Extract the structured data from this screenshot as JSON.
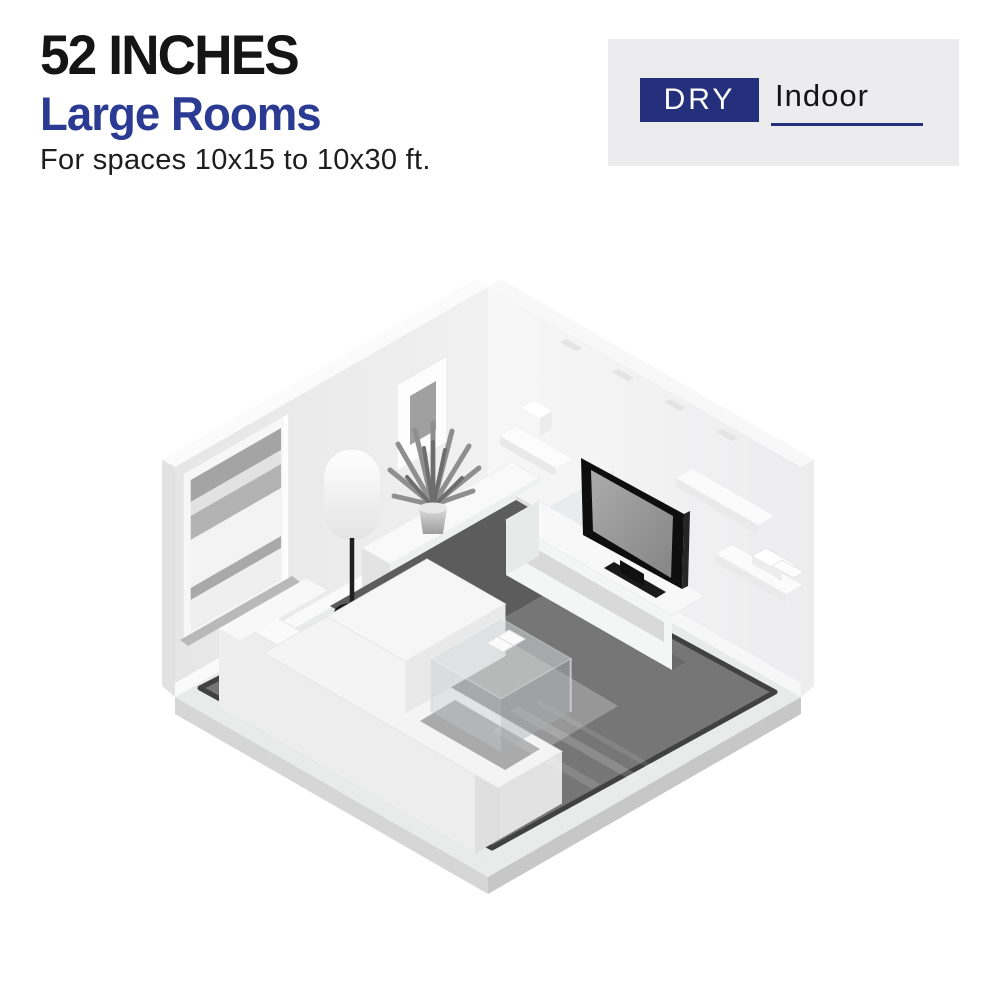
{
  "header": {
    "size_label": "52 INCHES",
    "room_label": "Large Rooms",
    "subtitle": "For spaces 10x15 to 10x30 ft."
  },
  "rating_badge": {
    "dry_label": "DRY",
    "location_label": "Indoor"
  },
  "colors": {
    "accent_blue": "#2b3a92",
    "badge_navy": "#24307c",
    "panel_gray": "#ececee",
    "heading_black": "#151515",
    "rug_gray": "#767676"
  },
  "illustration": {
    "type": "isometric-living-room-render",
    "elements": [
      "window-with-blinds",
      "framed-wall-art",
      "floating-wall-shelves",
      "storage-box",
      "sideboard-console",
      "potted-plant",
      "floor-lamp",
      "media-cabinet",
      "flat-screen-tv",
      "tv-stand",
      "l-shaped-sectional-sofa",
      "glass-coffee-table",
      "book",
      "area-rug"
    ]
  }
}
